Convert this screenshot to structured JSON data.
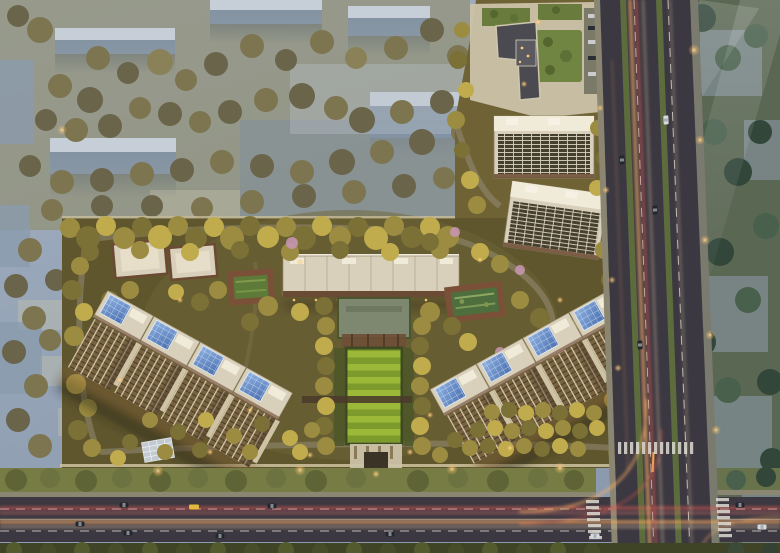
{
  "scene": {
    "type": "aerial-architectural-rendering",
    "subject": "residential-development-masterplan-at-dusk",
    "view": "top-down-birds-eye",
    "regions": {
      "background_city": "faded-blue-city-blocks-with-olive-trees",
      "greenbelt_east": "muted-green-field-with-ghost-buildings",
      "site": "warmly-lit-residential-compound",
      "arterial_road_east": "vertical-multilane-road-with-light-trails",
      "arterial_road_south": "horizontal-multilane-road-with-light-trails",
      "intersection_southeast": "signalized-crossroads-with-zebra-crossings"
    },
    "site_elements": {
      "north_commercial_complex": "mixed-use-block-with-rooftop-gardens",
      "lattice_roof_slabs": 2,
      "central_slab_building": 1,
      "west_villa_blocks": 2,
      "sunken_courtyards": 2,
      "central_lawn_axis": "striped-lawn-with-pergola-and-south-gate",
      "tower_row_west_units": 4,
      "tower_row_east_units": 4,
      "tower_roof_feature": "blue-glass-skylight-canopies"
    }
  },
  "palette": {
    "haze_top": "#a3b0c2",
    "haze_mid": "#8b9aae",
    "bg_ground": "#8e895e",
    "bg_building_body": "#8b9bae",
    "bg_building_top": "#d2d8e0",
    "bg_tree": "#7d7550",
    "east_ground": "#5a6753",
    "east_building": "#93a2b4",
    "east_tree": "#3d5242",
    "site_ground": "#5f562e",
    "site_ground_light": "#6f6336",
    "tree_warm_mid": "#9b8c41",
    "roof_cream": "#d9d0bb",
    "roof_white": "#efe9da",
    "facade_brown": "#6b4a33",
    "tower_facade": "#77623f",
    "mullion_cream": "#d5c9ab",
    "glass_blue_light": "#8fb2e2",
    "glass_blue_dark": "#4a6fae",
    "lawn_light": "#9cb838",
    "lawn_dark": "#7d9a2c",
    "hedge_dark": "#3e4a21",
    "pool_green": "#4e6e3e",
    "court_deck": "#7a5138",
    "plaza_cream": "#cbc2a9",
    "green_roof": "#697c3d",
    "dark_roof": "#4a4a50",
    "path_gray": "#948c75",
    "wall_cream": "#cfc3a0",
    "road_asphalt": "#3c3841",
    "sidewalk_gray": "#8a8672",
    "median_green": "#5d6c3c",
    "verge_green": "#767c44",
    "road_line_white": "#e6e4da",
    "trail_red": "#e85c55",
    "trail_amber": "#ffb066",
    "trail_white": "#ffe3b8",
    "lamp_glow": "#ffe9b8",
    "pink_tree": "#c795b0",
    "car_dark": "#23262c",
    "car_yellow": "#e3b93c",
    "car_white": "#d7dade",
    "zebra_white": "#dddbd2"
  }
}
